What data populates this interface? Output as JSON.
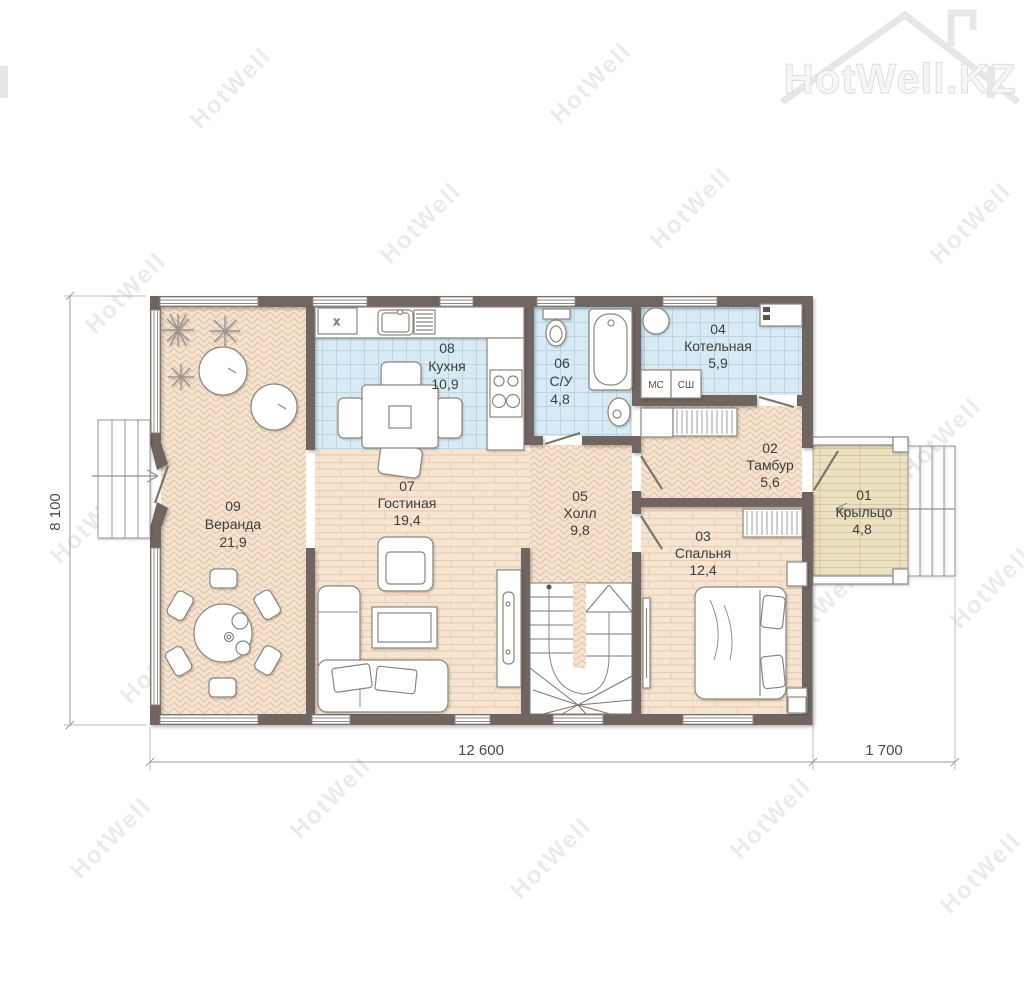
{
  "brand": {
    "logo_text": "HotWell.KZ"
  },
  "watermark": {
    "text": "HotWell"
  },
  "rooms": [
    {
      "number": "01",
      "name": "Крыльцо",
      "area": "4,8"
    },
    {
      "number": "02",
      "name": "Тамбур",
      "area": "5,6"
    },
    {
      "number": "03",
      "name": "Спальня",
      "area": "12,4"
    },
    {
      "number": "04",
      "name": "Котельная",
      "area": "5,9"
    },
    {
      "number": "05",
      "name": "Холл",
      "area": "9,8"
    },
    {
      "number": "06",
      "name": "С/У",
      "area": "4,8"
    },
    {
      "number": "07",
      "name": "Гостиная",
      "area": "19,4"
    },
    {
      "number": "08",
      "name": "Кухня",
      "area": "10,9"
    },
    {
      "number": "09",
      "name": "Веранда",
      "area": "21,9"
    }
  ],
  "labels": {
    "washer": "МС",
    "dryer": "СШ",
    "fridge": "x"
  },
  "dimensions": {
    "height": "8 100",
    "width_main": "12 600",
    "width_porch": "1 700"
  },
  "colors": {
    "wall": "#6f6560",
    "tile": "#d8ebf4",
    "wood": "#f5e3d0",
    "deck": "#eae2c2",
    "label": "#3d3d3d"
  }
}
